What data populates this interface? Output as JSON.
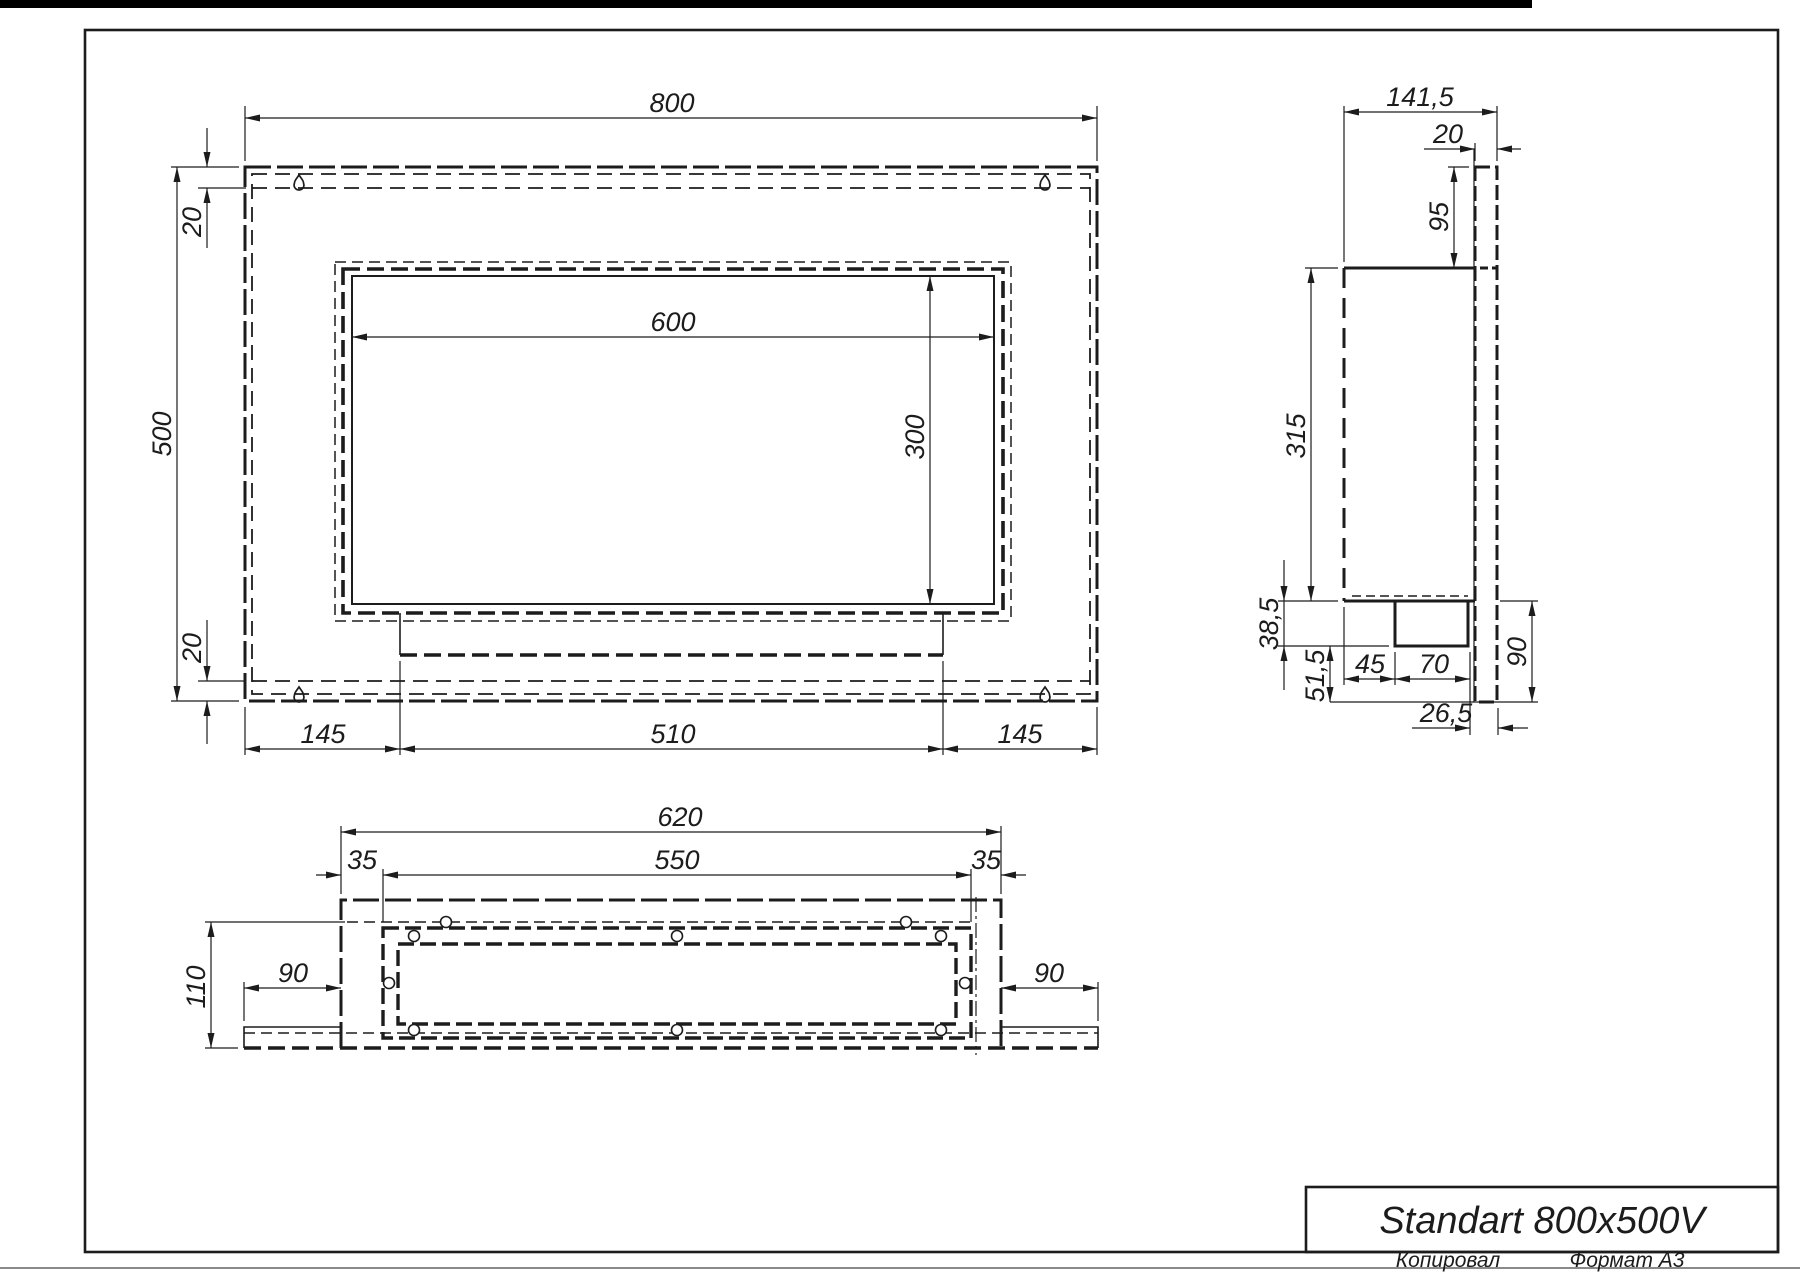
{
  "page": {
    "top_bar_color": "#000000",
    "line_color": "#1c1c1c",
    "page_edge_color": "#8a8a8a",
    "footer": {
      "copied_label": "Копировал",
      "format_label": "Формат А3"
    }
  },
  "title_block": {
    "product_name": "Standart 800x500V"
  },
  "front_view": {
    "dims": {
      "width": "800",
      "height": "500",
      "offset_top": "20",
      "offset_bottom": "20",
      "opening_width": "600",
      "opening_height": "300",
      "foot_left": "145",
      "foot_center": "510",
      "foot_right": "145"
    },
    "icons": {
      "mount_slot": "keyhole-mounting-slot"
    }
  },
  "side_view": {
    "dims": {
      "depth": "141,5",
      "panel_thickness": "20",
      "top_inset": "95",
      "body_height": "315",
      "tray_drop": "38,5",
      "bottom_inset": "51,5",
      "tray_front_offset": "45",
      "tray_width": "70",
      "back_offset": "26,5",
      "panel_below_body": "90"
    }
  },
  "bottom_view": {
    "dims": {
      "outer_width": "620",
      "opening_width": "550",
      "side_inset_left": "35",
      "side_inset_right": "35",
      "depth": "110",
      "flange_left": "90",
      "flange_right": "90"
    }
  }
}
